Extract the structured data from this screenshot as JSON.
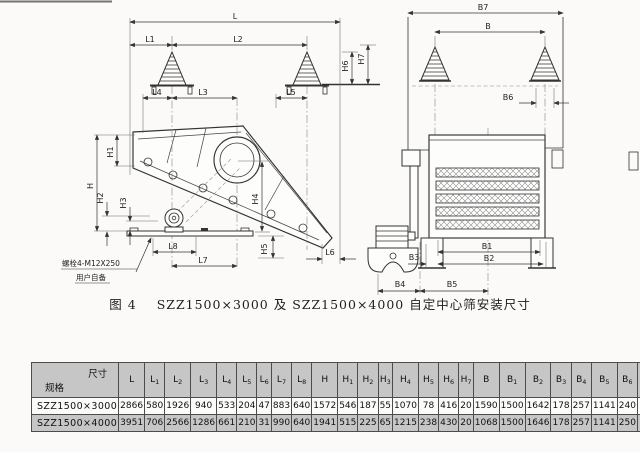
{
  "figure": {
    "number_label": "图 4",
    "title": "SZZ1500×3000 及 SZZ1500×4000 自定中心筛安装尺寸",
    "note": {
      "line1": "螺栓4-M12X250",
      "line2": "用户自备"
    }
  },
  "dims": {
    "L": "L",
    "L1": "L1",
    "L2": "L2",
    "L3": "L3",
    "L4": "L4",
    "L5": "L5",
    "L6": "L6",
    "L7": "L7",
    "L8": "L8",
    "H": "H",
    "H1": "H1",
    "H2": "H2",
    "H3": "H3",
    "H4": "H4",
    "H5": "H5",
    "H6": "H6",
    "H7": "H7",
    "B": "B",
    "B1": "B1",
    "B2": "B2",
    "B3": "B3",
    "B4": "B4",
    "B5": "B5",
    "B6": "B6",
    "B7": "B7"
  },
  "table": {
    "corner": {
      "top_right": "尺寸",
      "bottom_left": "规格"
    },
    "columns": [
      {
        "b": "L",
        "s": ""
      },
      {
        "b": "L",
        "s": "1"
      },
      {
        "b": "L",
        "s": "2"
      },
      {
        "b": "L",
        "s": "3"
      },
      {
        "b": "L",
        "s": "4"
      },
      {
        "b": "L",
        "s": "5"
      },
      {
        "b": "L",
        "s": "6"
      },
      {
        "b": "L",
        "s": "7"
      },
      {
        "b": "L",
        "s": "8"
      },
      {
        "b": "H",
        "s": ""
      },
      {
        "b": "H",
        "s": "1"
      },
      {
        "b": "H",
        "s": "2"
      },
      {
        "b": "H",
        "s": "3"
      },
      {
        "b": "H",
        "s": "4"
      },
      {
        "b": "H",
        "s": "5"
      },
      {
        "b": "H",
        "s": "6"
      },
      {
        "b": "H",
        "s": "7"
      },
      {
        "b": "B",
        "s": ""
      },
      {
        "b": "B",
        "s": "1"
      },
      {
        "b": "B",
        "s": "2"
      },
      {
        "b": "B",
        "s": "3"
      },
      {
        "b": "B",
        "s": "4"
      },
      {
        "b": "B",
        "s": "5"
      },
      {
        "b": "B",
        "s": "6"
      },
      {
        "b": "B",
        "s": "7"
      }
    ],
    "rows": [
      {
        "model": "SZZ1500×3000",
        "values": [
          "2866",
          "580",
          "1926",
          "940",
          "533",
          "204",
          "47",
          "883",
          "640",
          "1572",
          "546",
          "187",
          "55",
          "1070",
          "78",
          "416",
          "20",
          "1590",
          "1500",
          "1642",
          "178",
          "257",
          "1141",
          "240",
          "1888"
        ]
      },
      {
        "model": "SZZ1500×4000",
        "values": [
          "3951",
          "706",
          "2566",
          "1286",
          "661",
          "210",
          "31",
          "990",
          "640",
          "1941",
          "515",
          "225",
          "65",
          "1215",
          "238",
          "430",
          "20",
          "1068",
          "1500",
          "1646",
          "178",
          "257",
          "1141",
          "250",
          "1975"
        ]
      }
    ]
  }
}
